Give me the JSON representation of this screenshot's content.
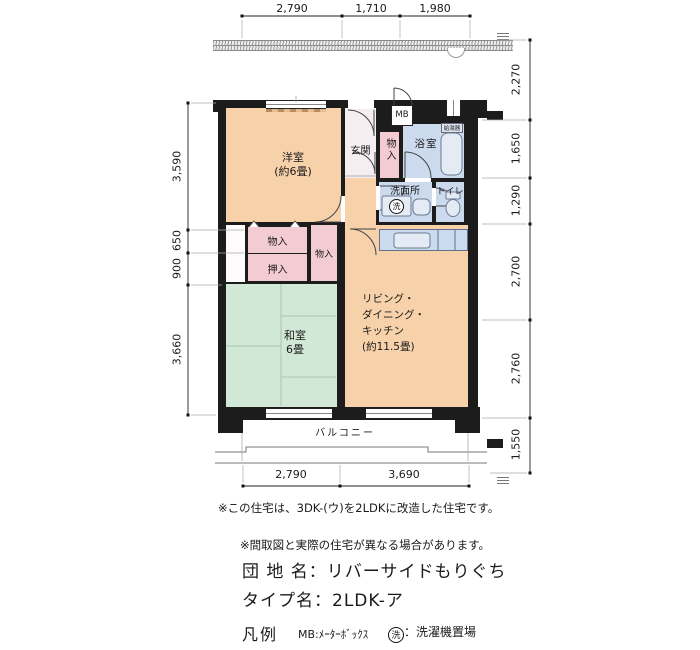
{
  "rooms": {
    "western": {
      "name": "洋室",
      "size": "(約6畳)"
    },
    "japanese": {
      "name": "和室",
      "size": "6畳"
    },
    "ldk": {
      "line1": "リビング・",
      "line2": "ダイニング・",
      "line3": "キッチン",
      "line4": "(約11.5畳)"
    },
    "entrance": "玄関",
    "bath": "浴室",
    "washroom": "洗面所",
    "toilet": "トイレ",
    "balcony": "バルコニー",
    "closet_hall": "物入",
    "closet_a": "物入",
    "closet_b": "物入",
    "oshiire": "押入",
    "meter_box": "MB",
    "water_heater": "給湯器",
    "wash_place": "洗"
  },
  "dimensions": {
    "top": [
      "2,790",
      "1,710",
      "1,980"
    ],
    "bottom": [
      "2,790",
      "3,690"
    ],
    "left": [
      "3,590",
      "650",
      "900",
      "3,660"
    ],
    "right": [
      "2,270",
      "1,650",
      "1,290",
      "2,700",
      "2,760",
      "1,550"
    ]
  },
  "notes": {
    "remodel": "※この住宅は、3DK-(ウ)を2LDKに改造した住宅です。",
    "difference": "※間取図と実際の住宅が異なる場合があります。"
  },
  "title_block": {
    "estate_name": "団 地 名：リバーサイドもりぐち",
    "type_name": "タイプ名：2LDK-ア"
  },
  "legend": {
    "title": "凡例",
    "mb": "MB:ﾒｰﾀｰﾎﾞｯｸｽ",
    "wash_symbol": "洗",
    "wash_text": "：洗濯機置場"
  },
  "colors": {
    "wall": "#1c1c1c",
    "room_peach": "#f6d1aa",
    "closet_pink": "#f3cbd2",
    "wet_blue": "#ccdaee",
    "tatami_green": "#d2e8d6",
    "entrance_white": "#f4eef0"
  }
}
